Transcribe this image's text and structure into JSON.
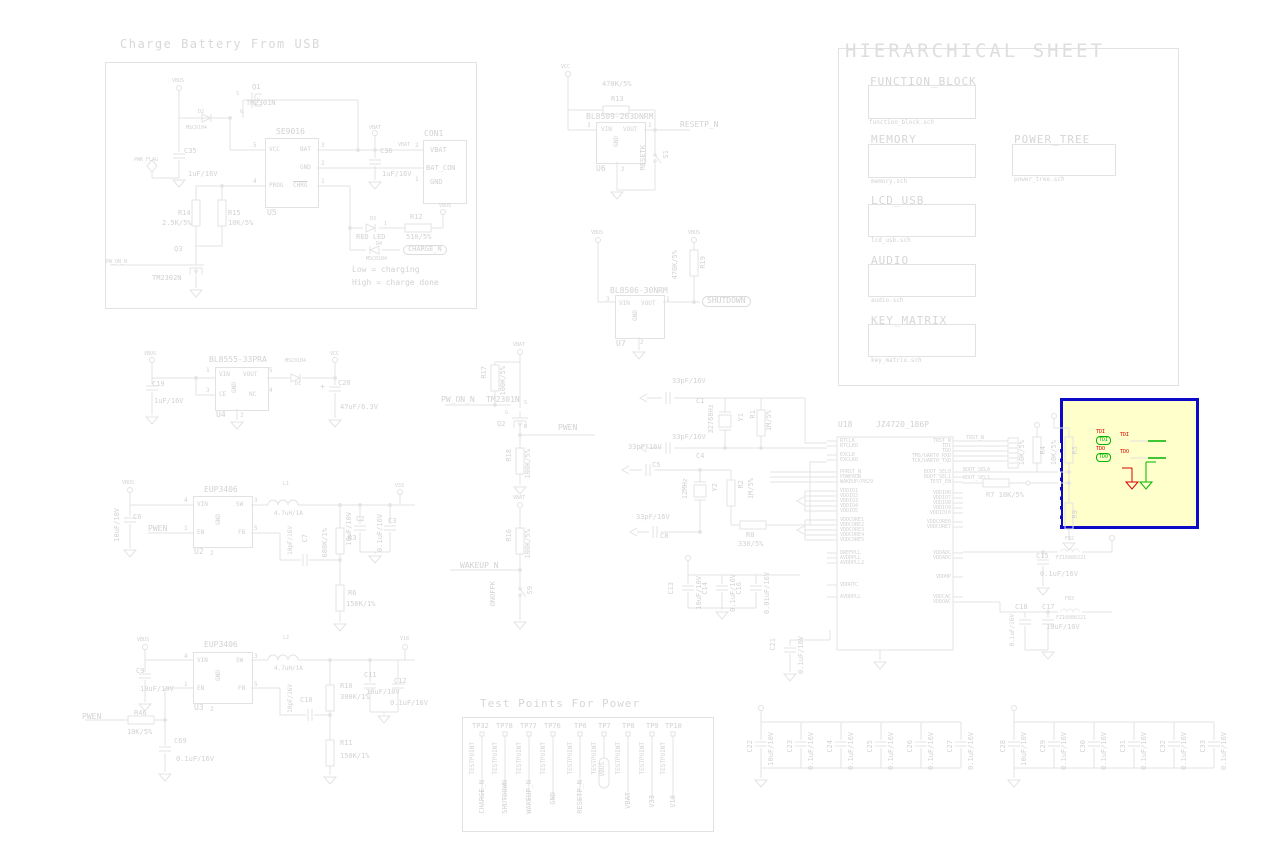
{
  "power_nets": {
    "vbus": "VBUS",
    "vcc": "VCC",
    "vbat": "VBAT",
    "v33": "V33",
    "v18": "V18"
  },
  "charge_block": {
    "title": "Charge Battery From USB",
    "q1_ref": "Q1",
    "q1_val": "TM2301N",
    "q1_s": "S",
    "q1_g": "G",
    "d2_ref": "D2",
    "d2_val": "MSC0104",
    "c35_ref": "C35",
    "c35_val": "1uF/16V",
    "pwr_flag": "PWR_FLAG",
    "u5_ref": "U5",
    "u5_val": "SE9016",
    "u5_pin_vcc": "VCC",
    "u5_pin_bat": "BAT",
    "u5_pin_gnd": "GND",
    "u5_pin_prog": "PROG",
    "u5_pin_chrg": "CHRG",
    "u5_num_vcc": "5",
    "u5_num_bat": "3",
    "u5_num_gnd": "2",
    "u5_num_prog": "4",
    "u5_num_chrg": "1",
    "c36_ref": "C36",
    "c36_val": "1uF/16V",
    "con1_ref": "CON1",
    "con1_pin_vbat": "VBAT",
    "con1_pin_batcon": "BAT_CON",
    "con1_pin_gnd": "GND",
    "con1_num2": "2",
    "con1_num1": "1",
    "r14_ref": "R14",
    "r14_val": "2.5K/5%",
    "r15_ref": "R15",
    "r15_val": "10K/5%",
    "q3_ref": "Q3",
    "q3_val": "TM2302N",
    "pw_on_n": "PW_ON_N",
    "d3_ref": "D3",
    "d3_val": "RED LED",
    "d3_num": "1",
    "r12_ref": "R12",
    "r12_val": "510/5%",
    "d4_ref": "D4",
    "d4_val": "MSC0104",
    "charge_n": "CHARGE_N",
    "note1": "Low = charging",
    "note2": "High = charge done"
  },
  "reset_block": {
    "r13_ref": "R13",
    "r13_val": "470K/5%",
    "u6_ref": "U6",
    "u6_val": "BL8509-263DNRM",
    "pin_vin": "VIN",
    "pin_vout": "VOUT",
    "pin_gnd": "GND",
    "num_vin": "3",
    "num_vout": "1",
    "num_gnd": "2",
    "net": "RESETP_N",
    "s1_ref": "S1",
    "s1_val": "RESETK"
  },
  "hier": {
    "title": "HIERARCHICAL SHEET",
    "sheets": [
      {
        "name": "FUNCTION_BLOCK",
        "file": "function_block.sch"
      },
      {
        "name": "MEMORY",
        "file": "memory.sch"
      },
      {
        "name": "POWER_TREE",
        "file": "power_tree.sch"
      },
      {
        "name": "LCD_USB",
        "file": "lcd_usb.sch"
      },
      {
        "name": "AUDIO",
        "file": "audio.sch"
      },
      {
        "name": "KEY_MATRIX",
        "file": "key_matrix.sch"
      }
    ]
  },
  "ldo33": {
    "u4_ref": "U4",
    "u4_val": "BL8555-33PRA",
    "pin_vin": "VIN",
    "pin_vout": "VOUT",
    "pin_ce": "CE",
    "pin_nc": "NC",
    "pin_gnd": "GND",
    "num_vin": "1",
    "num_vout": "5",
    "num_ce": "3",
    "num_nc": "4",
    "num_gnd": "2",
    "c19_ref": "C19",
    "c19_val": "1uF/16V",
    "d1_ref": "D1",
    "d1_val": "MSC0104",
    "c20_ref": "C20",
    "c20_val": "47uF/6.3V",
    "c20_plus": "+"
  },
  "ldo30": {
    "u7_ref": "U7",
    "u7_val": "BL8506-30NRM",
    "pin_vin": "VIN",
    "pin_vout": "VOUT",
    "pin_gnd": "GND",
    "num_vin": "3",
    "num_vout": "1",
    "num_gnd": "2",
    "r19_ref": "R19",
    "r19_val": "470K/5%",
    "net": "SHUTDOWN"
  },
  "pwr_switch": {
    "r17_ref": "R17",
    "r17_val": "100K/5%",
    "q2_ref": "Q2",
    "q2_val": "TM2301N",
    "q2_s": "S",
    "q2_g": "G",
    "q2_d": "D",
    "net_in": "PW_ON_N",
    "net_out": "PWEN",
    "r18_ref": "R18",
    "r18_val": "100K/5%",
    "r16_ref": "R16",
    "r16_val": "100K/5%",
    "net_wakeup": "WAKEUP_N",
    "s9_ref": "S9",
    "s9_val": "ONOFFK"
  },
  "buck1": {
    "u2_ref": "U2",
    "val": "EUP3406",
    "pin_vin": "VIN",
    "pin_sw": "SW",
    "pin_en": "EN",
    "pin_gnd": "GND",
    "pin_fb": "FB",
    "num_vin": "4",
    "num_sw": "3",
    "num_en": "1",
    "num_gnd": "2",
    "num_fb": "5",
    "l1_ref": "L1",
    "l1_val": "4.7uH/1A",
    "c6_ref": "C6",
    "c6_val": "10uF/10V",
    "net": "PWEN",
    "c7_ref": "C7",
    "c7_val": "10pF/16V",
    "r3_ref": "R3",
    "r3_val": "680K/1%",
    "r6_ref": "R6",
    "r6_val": "150K/1%",
    "c2_ref": "C2",
    "c2_val": "10uF/10V",
    "c3_ref": "C3",
    "c3_val": "0.1uF/16V"
  },
  "buck2": {
    "u3_ref": "U3",
    "val": "EUP3406",
    "pin_vin": "VIN",
    "pin_sw": "SW",
    "pin_en": "EN",
    "pin_gnd": "GND",
    "pin_fb": "FB",
    "num_vin": "4",
    "num_sw": "3",
    "num_en": "1",
    "num_gnd": "2",
    "num_fb": "5",
    "l2_ref": "L2",
    "l2_val": "4.7uH/1A",
    "c9_ref": "C9",
    "c9_val": "10uF/10V",
    "net": "PWEN",
    "r46_ref": "R46",
    "r46_val": "10K/5%",
    "c69_ref": "C69",
    "c69_val": "0.1uF/16V",
    "c10_ref": "C10",
    "c10_val": "10pF/16V",
    "r10_ref": "R10",
    "r10_val": "300K/1%",
    "r11_ref": "R11",
    "r11_val": "150K/1%",
    "c11_ref": "C11",
    "c11_val": "10uF/10V",
    "c12_ref": "C12",
    "c12_val": "0.1uF/16V"
  },
  "osc": {
    "c1_ref": "C1",
    "c1_val": "33pF/16V",
    "y1_ref": "Y1",
    "y1_val": "32768Hz",
    "r1_ref": "R1",
    "r1_val": "1M/5%",
    "c4_ref": "C4",
    "c4_val": "33pF/16V",
    "c5_ref": "C5",
    "c5_val": "33pF/16V",
    "y2_ref": "Y2",
    "y2_val": "12MHz",
    "r2_ref": "R2",
    "r2_val": "1M/5%",
    "c8_ref": "C8",
    "c8_val": "33pF/16V",
    "r8_ref": "R8",
    "r8_val": "330/5%"
  },
  "cpu": {
    "ref": "U18",
    "val": "JZ4720_186P",
    "left_pins": [
      "RTCLK",
      "RTCLKO",
      "EXCLK",
      "EXCLKO",
      "PPRST_N",
      "POWERON",
      "WAKEUP/PB29",
      "VDDIO1",
      "VDDIO2",
      "VDDIO3",
      "VDDIO4",
      "VDDIO5",
      "VDDCORE1",
      "VDDCORE2",
      "VDDCORE3",
      "VDDCORE4",
      "VDDCORE5",
      "DREFPLL",
      "AVDDPLL",
      "AVDDPLL2",
      "VDDRTC",
      "AVDDPLL"
    ],
    "right_pins": [
      "TRST_N",
      "TDI",
      "TDO",
      "TMS/UART0_RXD",
      "TCK/UART0_TXD",
      "BOOT_SEL0",
      "BOOT_SEL1",
      "TEST_EN",
      "VDDIO6",
      "VDDIO7",
      "VDDIO8",
      "VDDIO9",
      "VDDIO10",
      "VDDCORE6",
      "VDDCORE7",
      "VDDADC",
      "VDDADC",
      "VDDHP",
      "VDDCAC",
      "VDDOAC"
    ],
    "net_trst": "TRST_N",
    "net_boot0": "BOOT_SEL0",
    "net_boot1": "BOOT_SEL1",
    "r4_ref": "R4",
    "r4_val": "10K/5%",
    "r7_label": "R7 10K/5%",
    "r5_ref": "R5",
    "r5_val": "10K/5%",
    "r9_ref": "R9",
    "c13_ref": "C13",
    "c13_val": "10uF/10V",
    "c14_ref": "C14",
    "c14_val": "0.1uF/16V",
    "c16_ref": "C16",
    "c16_val": "0.01uF/16V",
    "c21_ref": "C21",
    "c21_val": "0.1uF/16V",
    "fb2_ref": "FB2",
    "fb2_val": "FZ16080221",
    "fb3_ref": "FB3",
    "fb3_val": "FZ16080221",
    "c15_ref": "C15",
    "c15_val": "0.1uF/16V",
    "c18_ref": "C18",
    "c18_val": "0.1uF/16V",
    "c17_ref": "C17",
    "c17_val": "10uF/10V"
  },
  "highlight": {
    "row1_red": "TDI",
    "row1_green": "TDI",
    "row2_red": "TDO",
    "row2_green": "TDO"
  },
  "testpoints": {
    "title": "Test Points For Power",
    "label": "TESTPOINT",
    "items": [
      {
        "ref": "TP32",
        "net": "CHARGE_N"
      },
      {
        "ref": "TP78",
        "net": "SHUTDOWN"
      },
      {
        "ref": "TP77",
        "net": "WAKEUP_N"
      },
      {
        "ref": "TP76",
        "net": "GND"
      },
      {
        "ref": "TP6",
        "net": "RESETP_N"
      },
      {
        "ref": "TP7",
        "net": "VBUS"
      },
      {
        "ref": "TP8",
        "net": "VBAT"
      },
      {
        "ref": "TP9",
        "net": "V33"
      },
      {
        "ref": "TP10",
        "net": "V18"
      }
    ]
  },
  "cap_bank1": [
    {
      "ref": "C22",
      "val": "10uF/10V"
    },
    {
      "ref": "C23",
      "val": "0.1uF/16V"
    },
    {
      "ref": "C24",
      "val": "0.1uF/16V"
    },
    {
      "ref": "C25",
      "val": "0.1uF/16V"
    },
    {
      "ref": "C26",
      "val": "0.1uF/16V"
    },
    {
      "ref": "C27",
      "val": "0.1uF/16V"
    }
  ],
  "cap_bank2": [
    {
      "ref": "C28",
      "val": "10uF/10V"
    },
    {
      "ref": "C29",
      "val": "0.1uF/16V"
    },
    {
      "ref": "C30",
      "val": "0.1uF/16V"
    },
    {
      "ref": "C31",
      "val": "0.1uF/16V"
    },
    {
      "ref": "C32",
      "val": "0.1uF/16V"
    },
    {
      "ref": "C33",
      "val": "0.1uF/16V"
    }
  ]
}
